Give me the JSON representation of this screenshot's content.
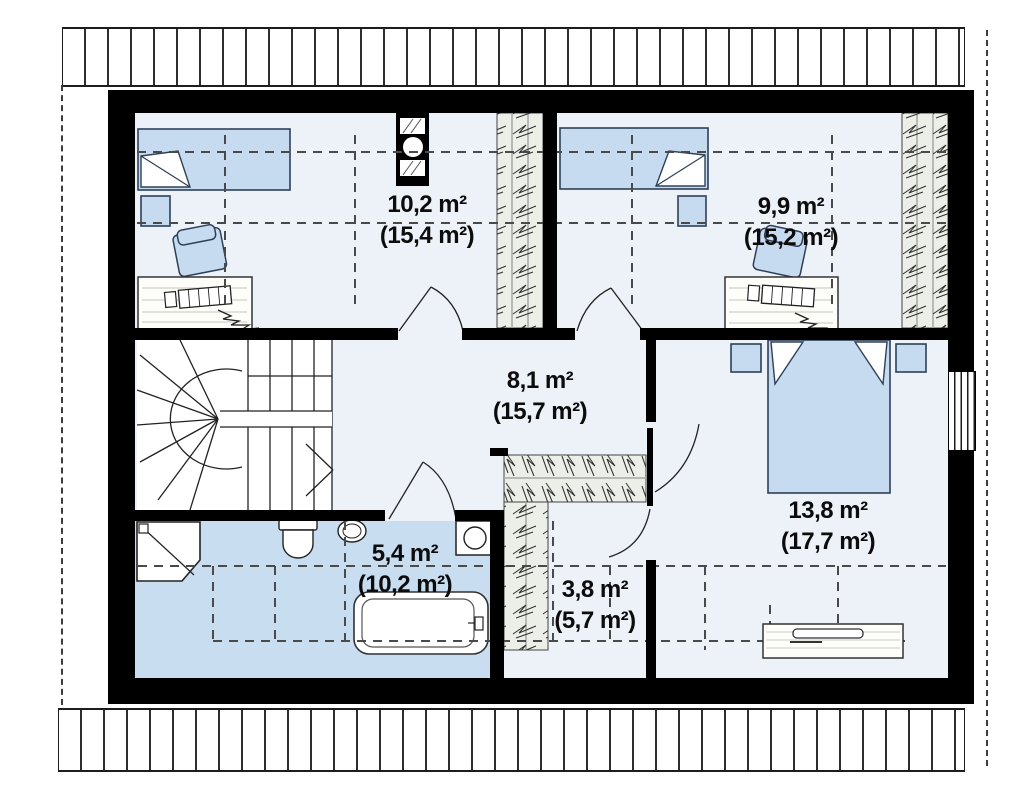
{
  "title": "Attic floor plan",
  "rooms": [
    {
      "name": "child-room-1",
      "area": "10,2 m²",
      "total": "(15,4 m²)"
    },
    {
      "name": "child-room-2",
      "area": "9,9 m²",
      "total": "(15,2 m²)"
    },
    {
      "name": "hall",
      "area": "8,1 m²",
      "total": "(15,7 m²)"
    },
    {
      "name": "bedroom",
      "area": "13,8 m²",
      "total": "(17,7 m²)"
    },
    {
      "name": "bathroom",
      "area": "5,4 m²",
      "total": "(10,2 m²)"
    },
    {
      "name": "wardrobe",
      "area": "3,8 m²",
      "total": "(5,7 m²)"
    }
  ],
  "colors": {
    "wall": "#000000",
    "room_floor": "#edf2f9",
    "bathroom_floor": "#c9ddf1",
    "furniture_fill": "#c6daf0",
    "closet_hatch_fill": "#eceee8",
    "stairs_fill": "#ffffff"
  },
  "fixtures": [
    "single-bed",
    "double-bed",
    "nightstand",
    "desk",
    "desk-chair",
    "stairs",
    "bathtub",
    "shower",
    "toilet",
    "sink",
    "washing-machine",
    "wardrobe-closet",
    "chimney",
    "dresser",
    "window",
    "door"
  ]
}
